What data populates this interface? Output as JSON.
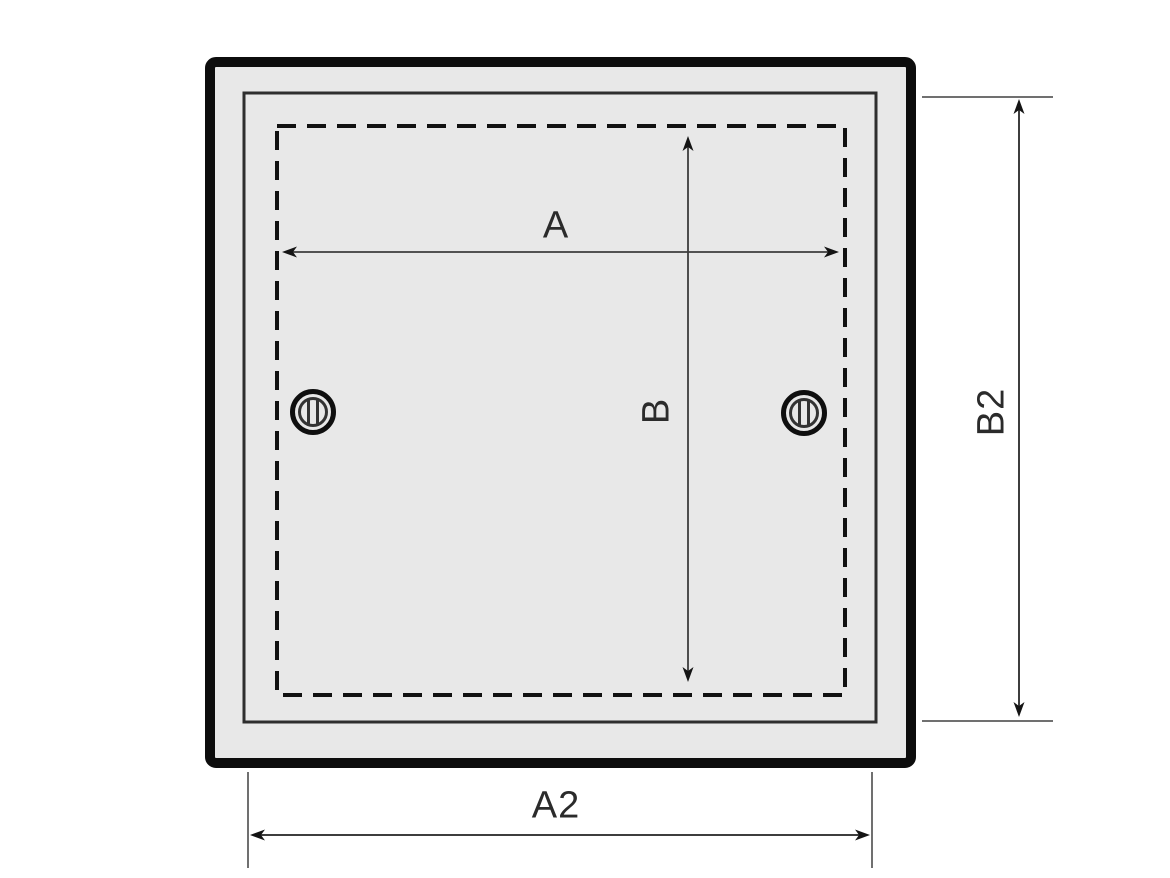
{
  "figure": {
    "description": "Technical dimension drawing of a square access panel with two slotted screws, a dashed cutout outline, and four dimension arrows"
  },
  "dimensions": {
    "inner_width_label": "A",
    "inner_height_label": "B",
    "outer_width_label": "A2",
    "outer_height_label": "B2"
  },
  "icons": {
    "left_screw": "screw-icon",
    "right_screw": "screw-icon"
  },
  "colors": {
    "background": "#ffffff",
    "panel_fill": "#e8e8e8",
    "outer_frame": "#0d0d0d",
    "inner_frame": "#2e2e2e",
    "dashed_outline": "#111111",
    "dimension_line": "#3d3d3d",
    "extension_line": "#707070",
    "label_text": "#2b2b2b"
  }
}
